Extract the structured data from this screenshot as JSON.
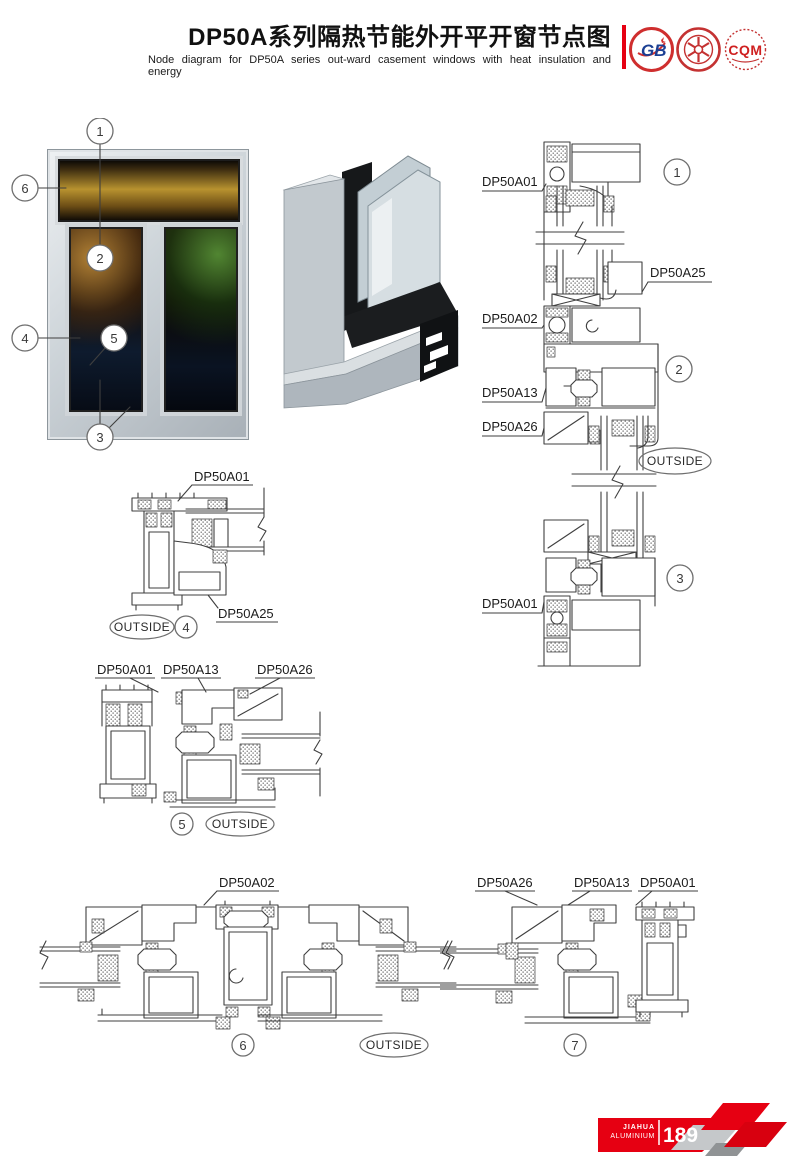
{
  "header": {
    "title": "DP50A系列隔热节能外开平开窗节点图",
    "subtitle": "Node diagram for DP50A series out-ward casement windows with heat insulation and energy",
    "logo_gb": "GB",
    "logo_cqm": "CQM"
  },
  "elevation": {
    "c1": "1",
    "c2": "2",
    "c3": "3",
    "c4": "4",
    "c5": "5",
    "c6": "6"
  },
  "vsection": {
    "top_label": "DP50A01",
    "label_25": "DP50A25",
    "label_02": "DP50A02",
    "label_13": "DP50A13",
    "label_26": "DP50A26",
    "bottom_label": "DP50A01",
    "c1": "1",
    "c2": "2",
    "c3": "3",
    "outside": "OUTSIDE"
  },
  "detail4": {
    "label_01": "DP50A01",
    "label_25": "DP50A25",
    "outside": "OUTSIDE",
    "num": "4"
  },
  "detail5": {
    "label_01": "DP50A01",
    "label_13": "DP50A13",
    "label_26": "DP50A26",
    "outside": "OUTSIDE",
    "num": "5"
  },
  "section6": {
    "label_02": "DP50A02",
    "outside": "OUTSIDE",
    "num": "6"
  },
  "section7": {
    "label_26": "DP50A26",
    "label_13": "DP50A13",
    "label_01": "DP50A01",
    "num": "7"
  },
  "footer": {
    "brand_line1": "JIAHUA",
    "brand_line2": "ALUMINIUM",
    "page": "189"
  }
}
